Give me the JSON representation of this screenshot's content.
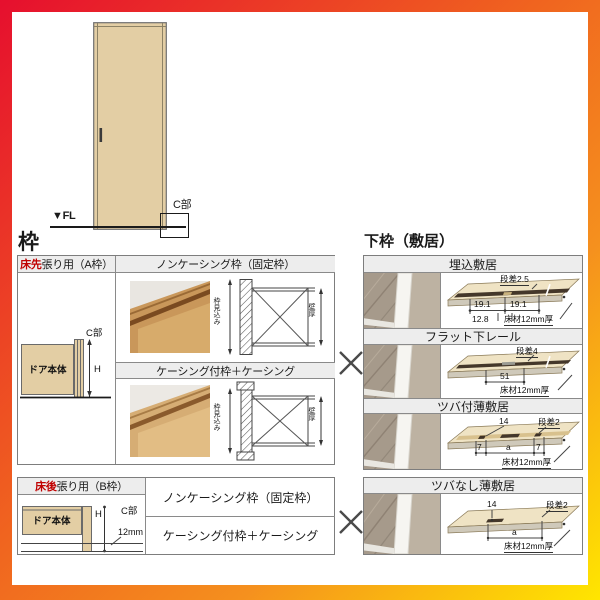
{
  "colors": {
    "border_gradient_start": "#e60f2e",
    "border_gradient_mid": "#f5811e",
    "border_gradient_end": "#ffe600",
    "red_text": "#c00000",
    "wood_fill": "#e3cea4",
    "header_bg": "#ededed"
  },
  "headings": {
    "frame": "枠",
    "lower_frame": "下枠（敷居）"
  },
  "door_figure": {
    "fl": "▼FL",
    "c": "C部"
  },
  "table_a": {
    "header_red": "床先",
    "header_rest": "張り用（A枠）",
    "diagram": {
      "door": "ドア本体",
      "c": "C部",
      "h": "H"
    },
    "rows": [
      {
        "title": "ノンケーシング枠（固定枠）",
        "depth": "枠見込み",
        "wall": "壁厚"
      },
      {
        "title": "ケーシング付枠＋ケーシング",
        "depth": "枠見込み",
        "wall": "壁厚"
      }
    ]
  },
  "table_b": {
    "header_red": "床後",
    "header_rest": "張り用（B枠）",
    "diagram": {
      "door": "ドア本体",
      "c": "C部",
      "h": "H",
      "floor_thickness": "12mm"
    },
    "rows": [
      {
        "title": "ノンケーシング枠（固定枠）"
      },
      {
        "title": "ケーシング付枠＋ケーシング"
      }
    ]
  },
  "sill_table": {
    "rows": [
      {
        "title": "埋込敷居",
        "step": "段差2.5",
        "left": "19.1",
        "right": "19.1",
        "center": "12.8",
        "floor": "床材12mm厚"
      },
      {
        "title": "フラット下レール",
        "step": "段差4",
        "center": "51",
        "floor": "床材12mm厚"
      },
      {
        "title": "ツバ付薄敷居",
        "top": "14",
        "step": "段差2",
        "left": "7",
        "center": "a",
        "right": "7",
        "floor": "床材12mm厚"
      },
      {
        "title": "ツバなし薄敷居",
        "top": "14",
        "step": "段差2",
        "center": "a",
        "floor": "床材12mm厚"
      }
    ]
  }
}
